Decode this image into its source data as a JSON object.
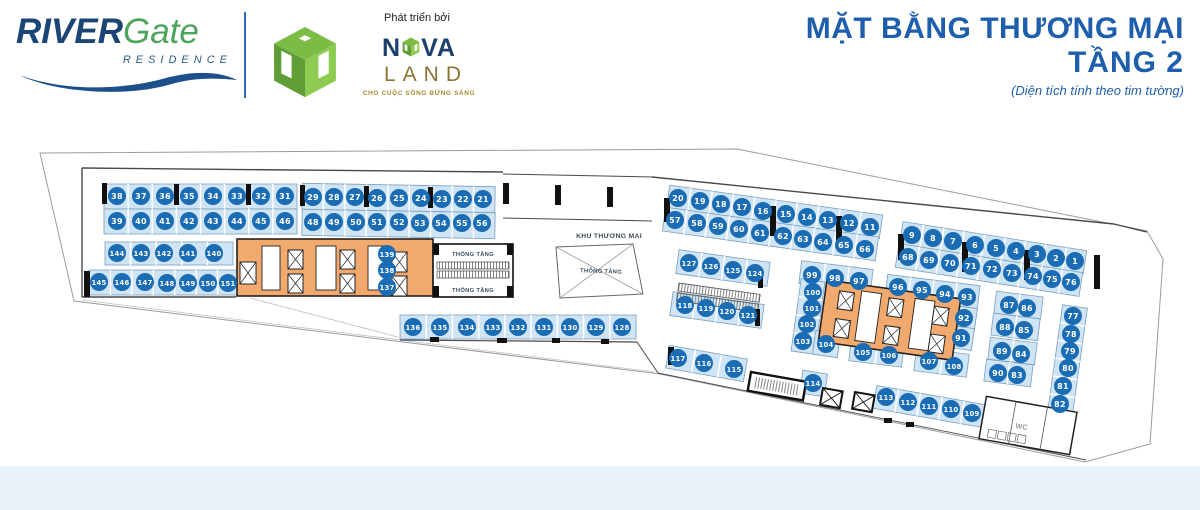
{
  "header": {
    "brand": {
      "river": "RIVER",
      "gate": "Gate",
      "residence": "RESIDENCE"
    },
    "developer": {
      "label": "Phát triển bởi",
      "nova_n": "N",
      "nova_va": "VA",
      "land": "LAND",
      "tagline": "CHO CUỘC SỐNG BỪNG SÁNG"
    },
    "title_line1": "MẶT BẰNG THƯƠNG MẠI",
    "title_line2": "TẦNG 2",
    "subtitle": "(Diện tích tính theo tim tường)"
  },
  "colors": {
    "stripFill": "#cfe4f4",
    "stripEdge": "#7b9fbd",
    "circle": "#1a6cb4",
    "circleText": "#ffffff",
    "orange": "#f2a96d",
    "wall": "#4a4a4a",
    "outline": "#9c9c9c",
    "band": "#e9f2fa",
    "labelDark": "#3c4c5c",
    "black": "#111111"
  },
  "plan": {
    "site": "40,153 737,149 1147,231 1163,259 1150,444 1085,462 660,374 74,301",
    "walls": [
      [
        82,
        168,
        82,
        297,
        1.4
      ],
      [
        82,
        168,
        503,
        172,
        1.4
      ],
      [
        503,
        174,
        652,
        177,
        1.0
      ],
      [
        503,
        218,
        652,
        221,
        1.0
      ],
      [
        652,
        177,
        1114,
        224,
        1.4
      ],
      [
        1114,
        224,
        1147,
        232,
        1.4
      ],
      [
        82,
        297,
        236,
        297,
        1.4
      ],
      [
        398,
        244,
        398,
        292,
        1.0
      ],
      [
        400,
        340,
        637,
        342,
        1.2
      ],
      [
        637,
        342,
        658,
        373,
        1.0
      ],
      [
        658,
        373,
        1086,
        460,
        0.9
      ]
    ],
    "faint": [
      [
        82,
        300,
        655,
        372
      ],
      [
        250,
        298,
        398,
        337
      ]
    ],
    "strips": [
      [
        104,
        184,
        193,
        25,
        0,
        8,
        0
      ],
      [
        104,
        209,
        193,
        25,
        0,
        8,
        0
      ],
      [
        302,
        185,
        193,
        26,
        1,
        9,
        0
      ],
      [
        302,
        211,
        193,
        26,
        1,
        9,
        0
      ],
      [
        105,
        242,
        128,
        23,
        0,
        5,
        0
      ],
      [
        89,
        270,
        150,
        25,
        0,
        7,
        0
      ],
      [
        376,
        244,
        22,
        48,
        0,
        3,
        1
      ],
      [
        400,
        315,
        236,
        24,
        0,
        9,
        0
      ],
      [
        667,
        200,
        215,
        24,
        8,
        10,
        0
      ],
      [
        663,
        222,
        215,
        24,
        8,
        10,
        0
      ],
      [
        900,
        236,
        186,
        24,
        9,
        9,
        0
      ],
      [
        896,
        258,
        186,
        24,
        9,
        9,
        0
      ],
      [
        677,
        256,
        92,
        24,
        8,
        4,
        0
      ],
      [
        671,
        298,
        92,
        24,
        8,
        4,
        0
      ],
      [
        800,
        265,
        72,
        23,
        7,
        3,
        0
      ],
      [
        886,
        280,
        93,
        23,
        7,
        4,
        0
      ],
      [
        796,
        280,
        24,
        73,
        8,
        4,
        1
      ],
      [
        814,
        332,
        25,
        24,
        8,
        1,
        0
      ],
      [
        850,
        341,
        53,
        23,
        7,
        2,
        0
      ],
      [
        915,
        351,
        53,
        23,
        7,
        2,
        0
      ],
      [
        953,
        307,
        23,
        22,
        8,
        1,
        0
      ],
      [
        950,
        327,
        23,
        22,
        8,
        1,
        0
      ],
      [
        995,
        294,
        47,
        22,
        7,
        2,
        0
      ],
      [
        992,
        316,
        47,
        22,
        7,
        2,
        0
      ],
      [
        989,
        340,
        47,
        22,
        7,
        2,
        0
      ],
      [
        985,
        362,
        47,
        22,
        7,
        2,
        0
      ],
      [
        1055,
        306,
        25,
        108,
        8,
        6,
        1
      ],
      [
        667,
        352,
        79,
        23,
        10,
        3,
        0
      ],
      [
        801,
        372,
        25,
        23,
        9,
        1,
        0
      ],
      [
        874,
        395,
        111,
        23,
        10,
        5,
        0
      ]
    ],
    "cores": [
      {
        "x": 237,
        "y": 239,
        "w": 196,
        "h": 57,
        "a": 0,
        "cx": 335,
        "cy": 267,
        "rooms": [
          [
            262,
            246,
            18,
            44
          ],
          [
            316,
            246,
            20,
            44
          ],
          [
            368,
            246,
            16,
            44
          ]
        ],
        "lifts": [
          [
            240,
            262,
            16,
            22
          ],
          [
            288,
            250,
            15,
            19
          ],
          [
            288,
            274,
            15,
            19
          ],
          [
            340,
            250,
            15,
            19
          ],
          [
            340,
            274,
            15,
            19
          ],
          [
            392,
            252,
            15,
            20
          ],
          [
            392,
            276,
            15,
            20
          ]
        ]
      },
      {
        "x": 822,
        "y": 289,
        "w": 135,
        "h": 62,
        "a": 8,
        "cx": 889,
        "cy": 320,
        "rooms": [
          [
            858,
            295,
            20,
            50
          ],
          [
            912,
            295,
            20,
            50
          ]
        ],
        "lifts": [
          [
            836,
            298,
            15,
            18
          ],
          [
            836,
            326,
            15,
            18
          ],
          [
            886,
            298,
            15,
            18
          ],
          [
            886,
            326,
            15,
            18
          ],
          [
            932,
            300,
            15,
            18
          ],
          [
            932,
            328,
            15,
            18
          ]
        ]
      }
    ],
    "escalator_left": {
      "x": 433,
      "y": 244,
      "w": 80,
      "h": 53
    },
    "escalator_right": {
      "x": 679,
      "y": 283,
      "w": 82,
      "h": 19,
      "a": 8
    },
    "escalator_bottom": {
      "x": 751,
      "y": 372,
      "w": 56,
      "h": 19,
      "a": 10
    },
    "lifts_small": [
      [
        823,
        388,
        20,
        17,
        10
      ],
      [
        855,
        392,
        20,
        17,
        10
      ]
    ],
    "trapezoid": {
      "points": "556,247 633,244 643,294 560,298"
    },
    "wc": {
      "x": 982,
      "y": 404,
      "w": 92,
      "h": 43,
      "a": 10,
      "label": "WC"
    },
    "marks": [
      [
        102,
        183,
        5,
        21
      ],
      [
        174,
        184,
        5,
        21
      ],
      [
        246,
        184,
        5,
        21
      ],
      [
        300,
        185,
        5,
        21
      ],
      [
        364,
        186,
        5,
        21
      ],
      [
        428,
        187,
        5,
        21
      ],
      [
        84,
        271,
        6,
        26
      ],
      [
        503,
        183,
        6,
        21
      ],
      [
        555,
        185,
        6,
        20
      ],
      [
        607,
        187,
        6,
        20
      ],
      [
        664,
        198,
        6,
        24
      ],
      [
        770,
        206,
        6,
        30
      ],
      [
        836,
        216,
        6,
        30
      ],
      [
        898,
        234,
        6,
        26
      ],
      [
        962,
        242,
        6,
        30
      ],
      [
        1024,
        250,
        6,
        30
      ],
      [
        1094,
        255,
        6,
        34
      ],
      [
        430,
        337,
        9,
        5
      ],
      [
        497,
        338,
        10,
        5
      ],
      [
        552,
        338,
        8,
        5
      ],
      [
        601,
        339,
        8,
        5
      ],
      [
        758,
        271,
        5,
        17
      ],
      [
        755,
        309,
        5,
        17
      ],
      [
        668,
        347,
        6,
        18
      ],
      [
        884,
        418,
        8,
        5
      ],
      [
        906,
        422,
        8,
        5
      ]
    ],
    "labels": [
      {
        "text": "KHU THƯƠNG MẠI",
        "x": 609,
        "y": 238,
        "size": 6.8,
        "rot": 0
      },
      {
        "text": "THÔNG TẦNG",
        "x": 473,
        "y": 256,
        "size": 5.8,
        "rot": 0
      },
      {
        "text": "THÔNG TẦNG",
        "x": 473,
        "y": 292,
        "size": 5.8,
        "rot": 0
      },
      {
        "text": "THÔNG TẦNG",
        "x": 601,
        "y": 273,
        "size": 5.8,
        "rot": 2
      }
    ],
    "units": [
      [
        "38",
        117,
        196
      ],
      [
        "37",
        141,
        196
      ],
      [
        "36",
        165,
        196
      ],
      [
        "35",
        189,
        196
      ],
      [
        "34",
        213,
        196
      ],
      [
        "33",
        237,
        196
      ],
      [
        "32",
        261,
        196
      ],
      [
        "31",
        285,
        196
      ],
      [
        "39",
        117,
        221
      ],
      [
        "40",
        141,
        221
      ],
      [
        "41",
        165,
        221
      ],
      [
        "42",
        189,
        221
      ],
      [
        "43",
        213,
        221
      ],
      [
        "44",
        237,
        221
      ],
      [
        "45",
        261,
        221
      ],
      [
        "46",
        285,
        221
      ],
      [
        "29",
        313,
        197
      ],
      [
        "28",
        334,
        197
      ],
      [
        "27",
        355,
        197
      ],
      [
        "26",
        377,
        198
      ],
      [
        "25",
        399,
        198
      ],
      [
        "24",
        421,
        198
      ],
      [
        "23",
        442,
        199
      ],
      [
        "22",
        463,
        199
      ],
      [
        "21",
        483,
        199
      ],
      [
        "48",
        313,
        222
      ],
      [
        "49",
        334,
        222
      ],
      [
        "50",
        356,
        222
      ],
      [
        "51",
        377,
        222
      ],
      [
        "52",
        399,
        222
      ],
      [
        "53",
        420,
        223
      ],
      [
        "54",
        441,
        223
      ],
      [
        "55",
        462,
        223
      ],
      [
        "56",
        482,
        223
      ],
      [
        "144",
        117,
        253
      ],
      [
        "143",
        141,
        253
      ],
      [
        "142",
        164,
        253
      ],
      [
        "141",
        188,
        253
      ],
      [
        "140",
        214,
        253
      ],
      [
        "145",
        99,
        282
      ],
      [
        "146",
        122,
        282
      ],
      [
        "147",
        145,
        282
      ],
      [
        "148",
        167,
        283
      ],
      [
        "149",
        188,
        283
      ],
      [
        "150",
        208,
        283
      ],
      [
        "151",
        228,
        283
      ],
      [
        "139",
        387,
        254
      ],
      [
        "138",
        387,
        270
      ],
      [
        "137",
        387,
        287
      ],
      [
        "136",
        413,
        327
      ],
      [
        "135",
        440,
        327
      ],
      [
        "134",
        467,
        327
      ],
      [
        "133",
        493,
        327
      ],
      [
        "132",
        518,
        327
      ],
      [
        "131",
        544,
        327
      ],
      [
        "130",
        570,
        327
      ],
      [
        "129",
        596,
        327
      ],
      [
        "128",
        622,
        327
      ],
      [
        "20",
        678,
        198
      ],
      [
        "19",
        700,
        201
      ],
      [
        "18",
        721,
        204
      ],
      [
        "17",
        742,
        207
      ],
      [
        "16",
        763,
        211
      ],
      [
        "15",
        786,
        214
      ],
      [
        "14",
        807,
        217
      ],
      [
        "13",
        828,
        220
      ],
      [
        "12",
        849,
        223
      ],
      [
        "11",
        870,
        227
      ],
      [
        "57",
        675,
        220
      ],
      [
        "58",
        697,
        223
      ],
      [
        "59",
        718,
        226
      ],
      [
        "60",
        739,
        229
      ],
      [
        "61",
        760,
        233
      ],
      [
        "62",
        783,
        236
      ],
      [
        "63",
        803,
        239
      ],
      [
        "64",
        823,
        242
      ],
      [
        "65",
        844,
        245
      ],
      [
        "66",
        865,
        249
      ],
      [
        "9",
        912,
        235
      ],
      [
        "8",
        933,
        238
      ],
      [
        "7",
        953,
        241
      ],
      [
        "6",
        975,
        245
      ],
      [
        "5",
        996,
        248
      ],
      [
        "4",
        1016,
        251
      ],
      [
        "3",
        1037,
        254
      ],
      [
        "2",
        1056,
        258
      ],
      [
        "1",
        1075,
        261
      ],
      [
        "68",
        908,
        257
      ],
      [
        "69",
        929,
        260
      ],
      [
        "70",
        950,
        263
      ],
      [
        "71",
        971,
        266
      ],
      [
        "72",
        992,
        269
      ],
      [
        "73",
        1012,
        273
      ],
      [
        "74",
        1033,
        276
      ],
      [
        "75",
        1052,
        279
      ],
      [
        "76",
        1071,
        282
      ],
      [
        "127",
        689,
        263
      ],
      [
        "126",
        711,
        266
      ],
      [
        "125",
        733,
        270
      ],
      [
        "124",
        755,
        273
      ],
      [
        "118",
        685,
        305
      ],
      [
        "119",
        706,
        308
      ],
      [
        "120",
        727,
        311
      ],
      [
        "121",
        748,
        315
      ],
      [
        "99",
        812,
        275
      ],
      [
        "98",
        835,
        278
      ],
      [
        "97",
        859,
        281
      ],
      [
        "96",
        898,
        287
      ],
      [
        "95",
        922,
        290
      ],
      [
        "94",
        945,
        294
      ],
      [
        "93",
        967,
        297
      ],
      [
        "100",
        813,
        292
      ],
      [
        "101",
        812,
        308
      ],
      [
        "102",
        807,
        324
      ],
      [
        "103",
        803,
        341
      ],
      [
        "104",
        826,
        344
      ],
      [
        "92",
        964,
        318
      ],
      [
        "91",
        961,
        338
      ],
      [
        "105",
        863,
        352
      ],
      [
        "106",
        889,
        355
      ],
      [
        "107",
        929,
        361
      ],
      [
        "108",
        954,
        366
      ],
      [
        "87",
        1009,
        305
      ],
      [
        "86",
        1027,
        308
      ],
      [
        "88",
        1005,
        327
      ],
      [
        "85",
        1024,
        330
      ],
      [
        "89",
        1002,
        351
      ],
      [
        "84",
        1021,
        354
      ],
      [
        "90",
        998,
        373
      ],
      [
        "83",
        1017,
        375
      ],
      [
        "77",
        1073,
        316
      ],
      [
        "78",
        1071,
        334
      ],
      [
        "79",
        1070,
        351
      ],
      [
        "80",
        1068,
        368
      ],
      [
        "81",
        1063,
        386
      ],
      [
        "82",
        1060,
        404
      ],
      [
        "117",
        678,
        358
      ],
      [
        "116",
        704,
        363
      ],
      [
        "115",
        734,
        369
      ],
      [
        "114",
        813,
        383
      ],
      [
        "113",
        886,
        397
      ],
      [
        "112",
        908,
        402
      ],
      [
        "111",
        929,
        406
      ],
      [
        "110",
        951,
        409
      ],
      [
        "109",
        972,
        413
      ]
    ]
  }
}
